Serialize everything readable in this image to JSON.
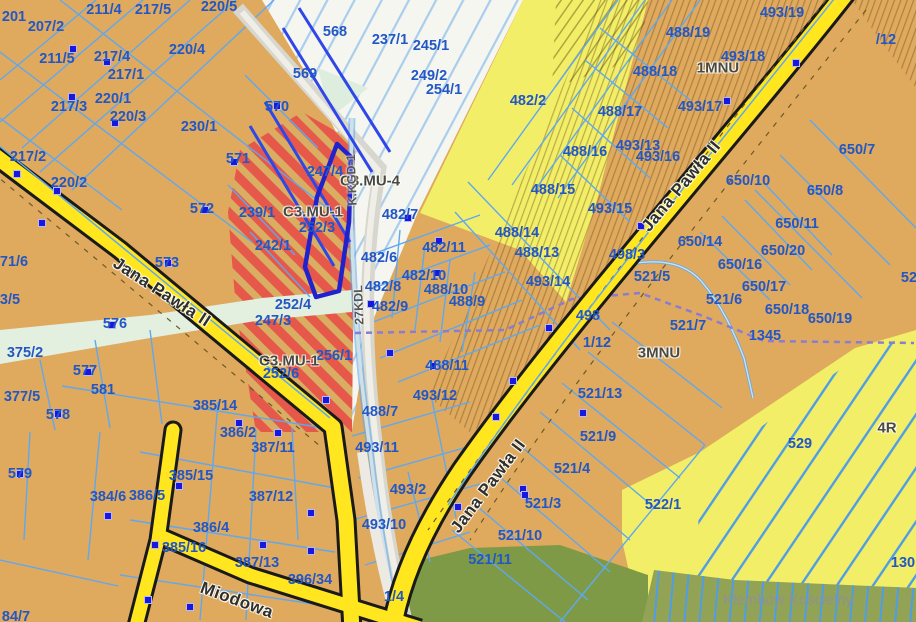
{
  "map": {
    "place_label": "Klembów Kościelny",
    "road_names": [
      "Jana Pawła II",
      "Miodowa"
    ],
    "corridor_codes": [
      "K.KGD-1",
      "27KDL"
    ],
    "zone_codes": [
      "C3.MU-4",
      "C3.MU-1",
      "1MNU",
      "3MNU",
      "4R"
    ],
    "colors": {
      "parcel_fill": "#dfa95e",
      "farm_yellow": "#f2ee67",
      "forest_green": "#8ba150",
      "road_yellow": "#ffe61e",
      "boundary_blue": "#5fa8f0",
      "label_blue": "#2257c5",
      "building_red": "#e03522",
      "selected_outline": "#2222cc",
      "stripe_red": "#e6594a"
    },
    "labels": [
      {
        "t": "201",
        "x": 14,
        "y": 17,
        "k": "parcel"
      },
      {
        "t": "207/2",
        "x": 46,
        "y": 27,
        "k": "parcel"
      },
      {
        "t": "211/4",
        "x": 104,
        "y": 10,
        "k": "parcel"
      },
      {
        "t": "217/5",
        "x": 153,
        "y": 10,
        "k": "parcel"
      },
      {
        "t": "220/5",
        "x": 219,
        "y": 7,
        "k": "parcel"
      },
      {
        "t": "211/5",
        "x": 57,
        "y": 59,
        "k": "parcel"
      },
      {
        "t": "217/4",
        "x": 112,
        "y": 57,
        "k": "parcel"
      },
      {
        "t": "217/1",
        "x": 126,
        "y": 75,
        "k": "parcel"
      },
      {
        "t": "220/4",
        "x": 187,
        "y": 50,
        "k": "parcel"
      },
      {
        "t": "217/3",
        "x": 69,
        "y": 107,
        "k": "parcel"
      },
      {
        "t": "220/1",
        "x": 113,
        "y": 99,
        "k": "parcel"
      },
      {
        "t": "220/3",
        "x": 128,
        "y": 117,
        "k": "parcel"
      },
      {
        "t": "230/1",
        "x": 199,
        "y": 127,
        "k": "parcel"
      },
      {
        "t": "570",
        "x": 277,
        "y": 107,
        "k": "parcel"
      },
      {
        "t": "571",
        "x": 238,
        "y": 159,
        "k": "parcel"
      },
      {
        "t": "568",
        "x": 335,
        "y": 32,
        "k": "parcel"
      },
      {
        "t": "569",
        "x": 305,
        "y": 74,
        "k": "parcel"
      },
      {
        "t": "237/1",
        "x": 390,
        "y": 40,
        "k": "parcel"
      },
      {
        "t": "245/1",
        "x": 431,
        "y": 46,
        "k": "parcel"
      },
      {
        "t": "249/2",
        "x": 429,
        "y": 76,
        "k": "parcel"
      },
      {
        "t": "254/1",
        "x": 444,
        "y": 90,
        "k": "parcel"
      },
      {
        "t": "482/2",
        "x": 528,
        "y": 101,
        "k": "parcel"
      },
      {
        "t": "217/2",
        "x": 28,
        "y": 157,
        "k": "parcel"
      },
      {
        "t": "220/2",
        "x": 69,
        "y": 183,
        "k": "parcel"
      },
      {
        "t": "572",
        "x": 202,
        "y": 209,
        "k": "parcel"
      },
      {
        "t": "239/1",
        "x": 257,
        "y": 213,
        "k": "parcel"
      },
      {
        "t": "242/1",
        "x": 273,
        "y": 246,
        "k": "parcel"
      },
      {
        "t": "247/4",
        "x": 325,
        "y": 172,
        "k": "parcel"
      },
      {
        "t": "252/3",
        "x": 317,
        "y": 228,
        "k": "parcel"
      },
      {
        "t": "71/6",
        "x": 14,
        "y": 262,
        "k": "parcel"
      },
      {
        "t": "3/5",
        "x": 10,
        "y": 300,
        "k": "parcel"
      },
      {
        "t": "573",
        "x": 167,
        "y": 263,
        "k": "parcel"
      },
      {
        "t": "252/4",
        "x": 293,
        "y": 305,
        "k": "parcel"
      },
      {
        "t": "247/3",
        "x": 273,
        "y": 321,
        "k": "parcel"
      },
      {
        "t": "256/1",
        "x": 334,
        "y": 356,
        "k": "parcel"
      },
      {
        "t": "252/6",
        "x": 281,
        "y": 374,
        "k": "parcel"
      },
      {
        "t": "576",
        "x": 115,
        "y": 324,
        "k": "parcel"
      },
      {
        "t": "375/2",
        "x": 25,
        "y": 353,
        "k": "parcel"
      },
      {
        "t": "577",
        "x": 85,
        "y": 371,
        "k": "parcel"
      },
      {
        "t": "581",
        "x": 103,
        "y": 390,
        "k": "parcel"
      },
      {
        "t": "377/5",
        "x": 22,
        "y": 397,
        "k": "parcel"
      },
      {
        "t": "578",
        "x": 58,
        "y": 415,
        "k": "parcel"
      },
      {
        "t": "579",
        "x": 20,
        "y": 474,
        "k": "parcel"
      },
      {
        "t": "384/6",
        "x": 108,
        "y": 497,
        "k": "parcel"
      },
      {
        "t": "385/14",
        "x": 215,
        "y": 406,
        "k": "parcel"
      },
      {
        "t": "386/2",
        "x": 238,
        "y": 433,
        "k": "parcel"
      },
      {
        "t": "387/11",
        "x": 273,
        "y": 448,
        "k": "parcel"
      },
      {
        "t": "385/15",
        "x": 191,
        "y": 476,
        "k": "parcel"
      },
      {
        "t": "386/5",
        "x": 147,
        "y": 496,
        "k": "parcel"
      },
      {
        "t": "386/4",
        "x": 211,
        "y": 528,
        "k": "parcel"
      },
      {
        "t": "385/16",
        "x": 184,
        "y": 548,
        "k": "parcel"
      },
      {
        "t": "387/12",
        "x": 271,
        "y": 497,
        "k": "parcel"
      },
      {
        "t": "387/13",
        "x": 257,
        "y": 563,
        "k": "parcel"
      },
      {
        "t": "396/34",
        "x": 310,
        "y": 580,
        "k": "parcel"
      },
      {
        "t": "84/7",
        "x": 16,
        "y": 617,
        "k": "parcel"
      },
      {
        "t": "493/12",
        "x": 435,
        "y": 396,
        "k": "parcel"
      },
      {
        "t": "488/7",
        "x": 380,
        "y": 412,
        "k": "parcel"
      },
      {
        "t": "493/11",
        "x": 377,
        "y": 448,
        "k": "parcel"
      },
      {
        "t": "493/2",
        "x": 408,
        "y": 490,
        "k": "parcel"
      },
      {
        "t": "493/10",
        "x": 384,
        "y": 525,
        "k": "parcel"
      },
      {
        "t": "1/4",
        "x": 394,
        "y": 597,
        "k": "parcel"
      },
      {
        "t": "488/15",
        "x": 553,
        "y": 190,
        "k": "parcel"
      },
      {
        "t": "488/14",
        "x": 517,
        "y": 233,
        "k": "parcel"
      },
      {
        "t": "488/13",
        "x": 537,
        "y": 253,
        "k": "parcel"
      },
      {
        "t": "493/14",
        "x": 548,
        "y": 282,
        "k": "parcel"
      },
      {
        "t": "482/7",
        "x": 400,
        "y": 215,
        "k": "parcel"
      },
      {
        "t": "482/11",
        "x": 444,
        "y": 248,
        "k": "parcel"
      },
      {
        "t": "482/6",
        "x": 379,
        "y": 258,
        "k": "parcel"
      },
      {
        "t": "482/10",
        "x": 424,
        "y": 276,
        "k": "parcel"
      },
      {
        "t": "488/10",
        "x": 446,
        "y": 290,
        "k": "parcel"
      },
      {
        "t": "488/9",
        "x": 467,
        "y": 302,
        "k": "parcel"
      },
      {
        "t": "482/8",
        "x": 383,
        "y": 287,
        "k": "parcel"
      },
      {
        "t": "482/9",
        "x": 390,
        "y": 307,
        "k": "parcel"
      },
      {
        "t": "488/11",
        "x": 447,
        "y": 366,
        "k": "parcel"
      },
      {
        "t": "488/16",
        "x": 585,
        "y": 152,
        "k": "parcel"
      },
      {
        "t": "493/15",
        "x": 610,
        "y": 209,
        "k": "parcel"
      },
      {
        "t": "498/3",
        "x": 627,
        "y": 255,
        "k": "parcel"
      },
      {
        "t": "493/19",
        "x": 782,
        "y": 13,
        "k": "parcel"
      },
      {
        "t": "488/19",
        "x": 688,
        "y": 33,
        "k": "parcel"
      },
      {
        "t": "493/18",
        "x": 743,
        "y": 57,
        "k": "parcel"
      },
      {
        "t": "488/18",
        "x": 655,
        "y": 72,
        "k": "parcel"
      },
      {
        "t": "493/17",
        "x": 700,
        "y": 107,
        "k": "parcel"
      },
      {
        "t": "488/17",
        "x": 620,
        "y": 112,
        "k": "parcel"
      },
      {
        "t": "493/13",
        "x": 638,
        "y": 146,
        "k": "parcel"
      },
      {
        "t": "493/16",
        "x": 658,
        "y": 157,
        "k": "parcel"
      },
      {
        "t": "/12",
        "x": 886,
        "y": 40,
        "k": "parcel"
      },
      {
        "t": "650/7",
        "x": 857,
        "y": 150,
        "k": "parcel"
      },
      {
        "t": "650/8",
        "x": 825,
        "y": 191,
        "k": "parcel"
      },
      {
        "t": "650/10",
        "x": 748,
        "y": 181,
        "k": "parcel"
      },
      {
        "t": "650/11",
        "x": 797,
        "y": 224,
        "k": "parcel"
      },
      {
        "t": "650/20",
        "x": 783,
        "y": 251,
        "k": "parcel"
      },
      {
        "t": "650/16",
        "x": 740,
        "y": 265,
        "k": "parcel"
      },
      {
        "t": "650/17",
        "x": 764,
        "y": 287,
        "k": "parcel"
      },
      {
        "t": "650/18",
        "x": 787,
        "y": 310,
        "k": "parcel"
      },
      {
        "t": "650/19",
        "x": 830,
        "y": 319,
        "k": "parcel"
      },
      {
        "t": "650/14",
        "x": 700,
        "y": 242,
        "k": "parcel"
      },
      {
        "t": "521/5",
        "x": 652,
        "y": 277,
        "k": "parcel"
      },
      {
        "t": "52",
        "x": 909,
        "y": 278,
        "k": "parcel"
      },
      {
        "t": "498",
        "x": 588,
        "y": 316,
        "k": "parcel"
      },
      {
        "t": "1/12",
        "x": 597,
        "y": 343,
        "k": "parcel"
      },
      {
        "t": "521/6",
        "x": 724,
        "y": 300,
        "k": "parcel"
      },
      {
        "t": "521/7",
        "x": 688,
        "y": 326,
        "k": "parcel"
      },
      {
        "t": "1345",
        "x": 765,
        "y": 336,
        "k": "parcel"
      },
      {
        "t": "521/13",
        "x": 600,
        "y": 394,
        "k": "parcel"
      },
      {
        "t": "521/9",
        "x": 598,
        "y": 437,
        "k": "parcel"
      },
      {
        "t": "521/4",
        "x": 572,
        "y": 469,
        "k": "parcel"
      },
      {
        "t": "521/3",
        "x": 543,
        "y": 504,
        "k": "parcel"
      },
      {
        "t": "521/10",
        "x": 520,
        "y": 536,
        "k": "parcel"
      },
      {
        "t": "521/11",
        "x": 490,
        "y": 560,
        "k": "parcel"
      },
      {
        "t": "529",
        "x": 800,
        "y": 444,
        "k": "parcel"
      },
      {
        "t": "522/1",
        "x": 663,
        "y": 505,
        "k": "parcel"
      },
      {
        "t": "130",
        "x": 903,
        "y": 563,
        "k": "parcel"
      },
      {
        "t": "C3.MU-4",
        "x": 370,
        "y": 181,
        "k": "zone"
      },
      {
        "t": "C3.MU-1",
        "x": 313,
        "y": 212,
        "k": "zone"
      },
      {
        "t": "C3.MU-1",
        "x": 289,
        "y": 361,
        "k": "zone"
      },
      {
        "t": "1MNU",
        "x": 718,
        "y": 68,
        "k": "zone"
      },
      {
        "t": "3MNU",
        "x": 659,
        "y": 353,
        "k": "zone"
      },
      {
        "t": "4R",
        "x": 887,
        "y": 428,
        "k": "zone"
      },
      {
        "t": "Jana Pawła II",
        "x": 162,
        "y": 292,
        "k": "road",
        "r": 33
      },
      {
        "t": "Jana Pawła II",
        "x": 488,
        "y": 486,
        "k": "road",
        "r": -53
      },
      {
        "t": "Jana Pawła II",
        "x": 681,
        "y": 186,
        "k": "road",
        "r": -50
      },
      {
        "t": "Miodowa",
        "x": 237,
        "y": 600,
        "k": "road",
        "r": 20
      },
      {
        "t": "K.KGD-1",
        "x": 352,
        "y": 180,
        "k": "corridor",
        "r": -92
      },
      {
        "t": "27KDL",
        "x": 359,
        "y": 305,
        "k": "corridor",
        "r": -92
      },
      {
        "t": "Klembów Kościelny",
        "x": 788,
        "y": 600,
        "k": "place"
      }
    ],
    "markers": [
      [
        73,
        49
      ],
      [
        107,
        62
      ],
      [
        72,
        97
      ],
      [
        115,
        123
      ],
      [
        277,
        106
      ],
      [
        234,
        162
      ],
      [
        17,
        174
      ],
      [
        57,
        191
      ],
      [
        205,
        210
      ],
      [
        168,
        263
      ],
      [
        42,
        223
      ],
      [
        112,
        325
      ],
      [
        88,
        372
      ],
      [
        58,
        414
      ],
      [
        20,
        474
      ],
      [
        108,
        516
      ],
      [
        155,
        545
      ],
      [
        263,
        545
      ],
      [
        311,
        513
      ],
      [
        311,
        551
      ],
      [
        148,
        600
      ],
      [
        190,
        607
      ],
      [
        179,
        486
      ],
      [
        278,
        433
      ],
      [
        239,
        423
      ],
      [
        326,
        400
      ],
      [
        408,
        218
      ],
      [
        439,
        241
      ],
      [
        437,
        273
      ],
      [
        390,
        353
      ],
      [
        433,
        366
      ],
      [
        513,
        381
      ],
      [
        549,
        328
      ],
      [
        523,
        489
      ],
      [
        496,
        417
      ],
      [
        458,
        507
      ],
      [
        525,
        495
      ],
      [
        583,
        413
      ],
      [
        641,
        226
      ],
      [
        727,
        101
      ],
      [
        796,
        63
      ],
      [
        371,
        304
      ]
    ],
    "buildings": [
      [
        77,
        44,
        22,
        14,
        0
      ],
      [
        88,
        168,
        16,
        12,
        0
      ],
      [
        110,
        150,
        30,
        22,
        -18
      ],
      [
        152,
        163,
        34,
        25,
        -18
      ],
      [
        172,
        186,
        20,
        13,
        -18
      ],
      [
        120,
        182,
        14,
        10,
        0
      ],
      [
        250,
        196,
        17,
        13,
        45
      ],
      [
        16,
        224,
        20,
        14,
        0
      ],
      [
        35,
        262,
        16,
        11,
        0
      ],
      [
        163,
        266,
        22,
        16,
        -12
      ],
      [
        326,
        403,
        16,
        22,
        0
      ],
      [
        407,
        219,
        24,
        18,
        -40
      ],
      [
        385,
        250,
        22,
        16,
        -40
      ],
      [
        428,
        270,
        18,
        15,
        -40
      ],
      [
        523,
        304,
        20,
        17,
        -40
      ],
      [
        503,
        387,
        20,
        16,
        -40
      ],
      [
        375,
        510,
        32,
        24,
        -35
      ],
      [
        545,
        338,
        20,
        16,
        -40
      ],
      [
        551,
        451,
        22,
        18,
        0
      ],
      [
        523,
        488,
        20,
        18,
        0
      ],
      [
        502,
        515,
        20,
        16,
        0
      ],
      [
        526,
        569,
        10,
        12,
        0
      ],
      [
        508,
        589,
        18,
        20,
        0
      ],
      [
        589,
        385,
        10,
        10,
        0
      ],
      [
        256,
        500,
        22,
        20,
        0
      ],
      [
        281,
        546,
        22,
        18,
        0
      ],
      [
        314,
        515,
        14,
        22,
        0
      ],
      [
        293,
        600,
        12,
        22,
        0
      ],
      [
        187,
        607,
        24,
        16,
        0
      ],
      [
        151,
        606,
        14,
        16,
        0
      ],
      [
        60,
        575,
        14,
        34,
        0
      ],
      [
        79,
        591,
        16,
        10,
        0
      ],
      [
        102,
        590,
        10,
        22,
        0
      ],
      [
        15,
        560,
        20,
        12,
        0
      ],
      [
        666,
        578,
        24,
        30,
        0
      ],
      [
        880,
        370,
        24,
        16,
        -40
      ]
    ]
  }
}
